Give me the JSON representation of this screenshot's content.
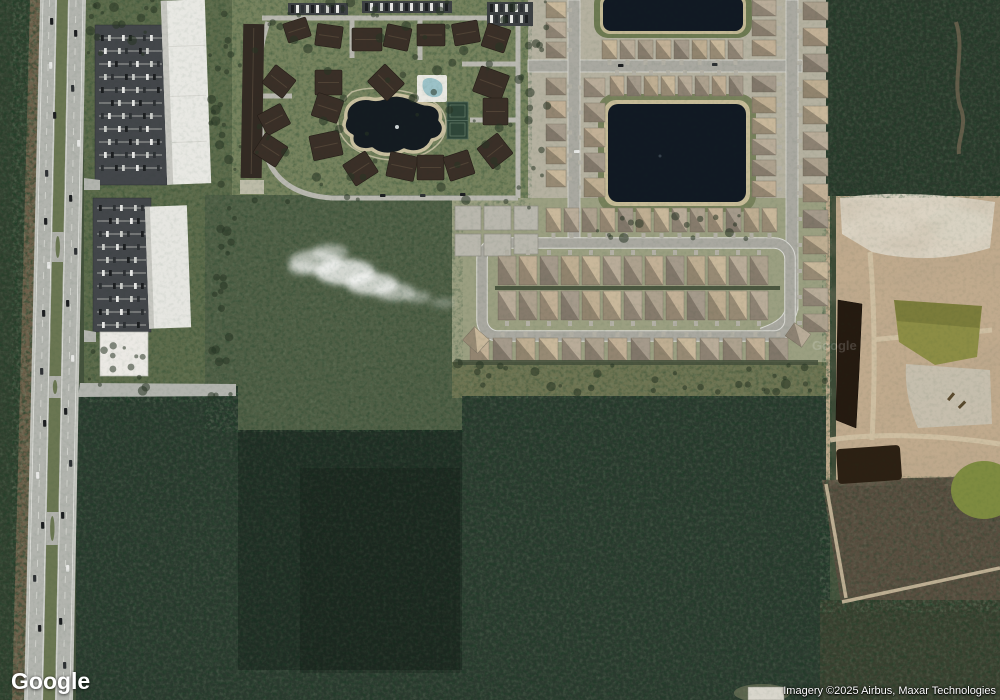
{
  "branding": {
    "logo_text": "Google"
  },
  "attribution": {
    "text": "Imagery ©2025 Airbus, Maxar Technologies"
  },
  "map": {
    "type": "satellite-imagery",
    "watermark_text": "Google",
    "features_shown": [
      "divided highway with median",
      "commercial parking lots",
      "white warehouse buildings",
      "apartment complex with central pond",
      "tennis courts",
      "swimming pool",
      "residential subdivision",
      "retention ponds",
      "looped residential street",
      "construction site with borrow pits",
      "pine forest",
      "scrub land",
      "cloud"
    ],
    "colors": {
      "forest": "#2b3a2f",
      "scrub": "#4f5e45",
      "field": "#6e7452",
      "subdivision_ground": "#b5b1a0",
      "loop_ground": "#9b9f81",
      "street": "#a9a8a0",
      "curb": "#d9d9d3",
      "highway": "#b2b4ae",
      "shoulder": "#c2c3bd",
      "median_grass": "#6a7652",
      "dirt": "#6d5f4a",
      "asphalt_lot": "#43464a",
      "white_roof": "#e8e8e3",
      "condo_ground": "#76825d",
      "condo_roof": "#3a2f27",
      "pond_water": "#111923",
      "pond_sand": "#c6bb97",
      "pond_grass_rim": "#6d7a52",
      "construction_tan": "#c0aa8d",
      "construction_sand": "#dcd5c6",
      "borrow_pit_dark": "#251a10",
      "borrow_pit_green": "#8c8d45",
      "scrub_brown": "#584d3f",
      "driveway": "#b3b0a5",
      "pad": "#b9b7ad"
    },
    "house_colors": [
      "#c9b89b",
      "#b9ac99",
      "#ada18e",
      "#c2b096",
      "#a59a8b",
      "#bfae92"
    ],
    "car_colors": [
      "#1c1e20",
      "#e8e8e6",
      "#2e3134",
      "#caccc8"
    ],
    "house_rows": [
      {
        "o": "v",
        "x": 546,
        "y": 2,
        "n": 3,
        "s": 20,
        "w": 20,
        "h": 16,
        "dr": "r",
        "ci": 0
      },
      {
        "o": "v",
        "x": 546,
        "y": 78,
        "n": 5,
        "s": 23,
        "w": 20,
        "h": 17,
        "dr": "r",
        "ci": 2
      },
      {
        "o": "v",
        "x": 584,
        "y": 78,
        "n": 5,
        "s": 25,
        "w": 21,
        "h": 19,
        "dr": "l",
        "ci": 1
      },
      {
        "o": "h",
        "x": 602,
        "y": 40,
        "n": 8,
        "s": 18,
        "w": 15,
        "h": 19,
        "dr": "d",
        "ci": 0
      },
      {
        "o": "h",
        "x": 610,
        "y": 76,
        "n": 8,
        "s": 17,
        "w": 14,
        "h": 20,
        "dr": "u",
        "ci": 3
      },
      {
        "o": "v",
        "x": 752,
        "y": 0,
        "n": 3,
        "s": 20,
        "w": 24,
        "h": 16,
        "dr": "r",
        "ci": 1
      },
      {
        "o": "v",
        "x": 752,
        "y": 76,
        "n": 6,
        "s": 21,
        "w": 24,
        "h": 16,
        "dr": "r",
        "ci": 4
      },
      {
        "o": "v",
        "x": 803,
        "y": 2,
        "n": 13,
        "s": 26,
        "w": 25,
        "h": 18,
        "dr": "l",
        "ci": 2
      },
      {
        "o": "h",
        "x": 546,
        "y": 208,
        "n": 13,
        "s": 18,
        "w": 15,
        "h": 24,
        "dr": "d",
        "ci": 0
      },
      {
        "o": "h",
        "x": 498,
        "y": 256,
        "n": 13,
        "s": 21,
        "w": 18,
        "h": 29,
        "dr": "u",
        "ci": 2
      },
      {
        "o": "h",
        "x": 498,
        "y": 291,
        "n": 13,
        "s": 21,
        "w": 18,
        "h": 29,
        "dr": "d",
        "ci": 1
      },
      {
        "o": "h",
        "x": 470,
        "y": 338,
        "n": 14,
        "s": 23,
        "w": 19,
        "h": 23,
        "dr": "u",
        "ci": 3
      }
    ],
    "rotated_houses": [
      [
        466,
        331,
        20,
        18,
        42
      ],
      [
        788,
        327,
        20,
        16,
        35
      ]
    ],
    "construction_pads": [
      [
        455,
        206,
        26,
        24
      ],
      [
        484,
        206,
        27,
        24
      ],
      [
        514,
        206,
        24,
        24
      ],
      [
        455,
        234,
        26,
        22
      ],
      [
        484,
        234,
        27,
        22
      ],
      [
        514,
        234,
        24,
        20
      ]
    ],
    "condo_buildings": [
      [
        285,
        20,
        24,
        20,
        -18
      ],
      [
        316,
        25,
        26,
        22,
        8
      ],
      [
        352,
        28,
        30,
        23,
        0
      ],
      [
        385,
        26,
        25,
        23,
        12
      ],
      [
        417,
        24,
        28,
        22,
        0
      ],
      [
        453,
        22,
        26,
        22,
        -10
      ],
      [
        484,
        26,
        24,
        24,
        18
      ],
      [
        266,
        70,
        26,
        23,
        38
      ],
      [
        315,
        70,
        27,
        25,
        0
      ],
      [
        372,
        70,
        28,
        25,
        45
      ],
      [
        476,
        70,
        30,
        27,
        20
      ],
      [
        261,
        108,
        26,
        23,
        -28
      ],
      [
        314,
        96,
        27,
        24,
        18
      ],
      [
        483,
        98,
        25,
        27,
        0
      ],
      [
        257,
        138,
        27,
        24,
        33
      ],
      [
        311,
        133,
        30,
        25,
        -12
      ],
      [
        347,
        156,
        27,
        25,
        -33
      ],
      [
        388,
        154,
        28,
        25,
        12
      ],
      [
        417,
        155,
        27,
        25,
        0
      ],
      [
        446,
        153,
        26,
        25,
        -18
      ],
      [
        482,
        138,
        26,
        26,
        -38
      ]
    ],
    "condo_parking_strips": [
      [
        288,
        3,
        60,
        12
      ],
      [
        362,
        1,
        90,
        12
      ],
      [
        487,
        2,
        46,
        24
      ]
    ],
    "parking_lots": [
      {
        "x": 95,
        "y": 25,
        "w": 72,
        "h": 160,
        "y0": 38,
        "step": 13
      },
      {
        "x": 93,
        "y": 198,
        "w": 58,
        "h": 134,
        "y0": 208,
        "step": 13
      }
    ],
    "highway_cars": [
      [
        50,
        18,
        0
      ],
      [
        49,
        62,
        1
      ],
      [
        53,
        112,
        0
      ],
      [
        45,
        170,
        2
      ],
      [
        44,
        218,
        0
      ],
      [
        47,
        262,
        1
      ],
      [
        42,
        310,
        0
      ],
      [
        40,
        368,
        2
      ],
      [
        43,
        420,
        0
      ],
      [
        36,
        472,
        1
      ],
      [
        41,
        522,
        0
      ],
      [
        33,
        575,
        2
      ],
      [
        38,
        625,
        0
      ],
      [
        74,
        30,
        0
      ],
      [
        71,
        85,
        2
      ],
      [
        77,
        140,
        1
      ],
      [
        69,
        195,
        0
      ],
      [
        74,
        248,
        2
      ],
      [
        66,
        300,
        0
      ],
      [
        71,
        355,
        1
      ],
      [
        64,
        408,
        0
      ],
      [
        69,
        460,
        2
      ],
      [
        61,
        512,
        0
      ],
      [
        66,
        565,
        1
      ],
      [
        59,
        618,
        0
      ],
      [
        63,
        662,
        2
      ]
    ],
    "street_cars": [
      [
        618,
        64,
        0
      ],
      [
        712,
        63,
        2
      ],
      [
        574,
        150,
        1
      ],
      [
        380,
        194,
        0
      ],
      [
        420,
        194,
        2
      ],
      [
        460,
        193,
        0
      ]
    ],
    "median_crossovers": [
      [
        232,
        262
      ],
      [
        376,
        398
      ],
      [
        512,
        545
      ]
    ],
    "tree_patches": [
      {
        "x": 236,
        "y": 2,
        "w": 292,
        "h": 200,
        "n": 70,
        "seed": 9
      },
      {
        "x": 88,
        "y": 0,
        "w": 70,
        "h": 55,
        "n": 18,
        "seed": 4
      },
      {
        "x": 210,
        "y": 0,
        "w": 26,
        "h": 400,
        "n": 40,
        "seed": 5
      },
      {
        "x": 86,
        "y": 345,
        "w": 60,
        "h": 50,
        "n": 14,
        "seed": 6
      },
      {
        "x": 455,
        "y": 363,
        "w": 370,
        "h": 32,
        "n": 34,
        "seed": 8
      },
      {
        "x": 596,
        "y": 212,
        "w": 150,
        "h": 28,
        "n": 16,
        "seed": 12
      },
      {
        "x": 528,
        "y": 0,
        "w": 20,
        "h": 210,
        "n": 14,
        "seed": 13
      }
    ]
  }
}
